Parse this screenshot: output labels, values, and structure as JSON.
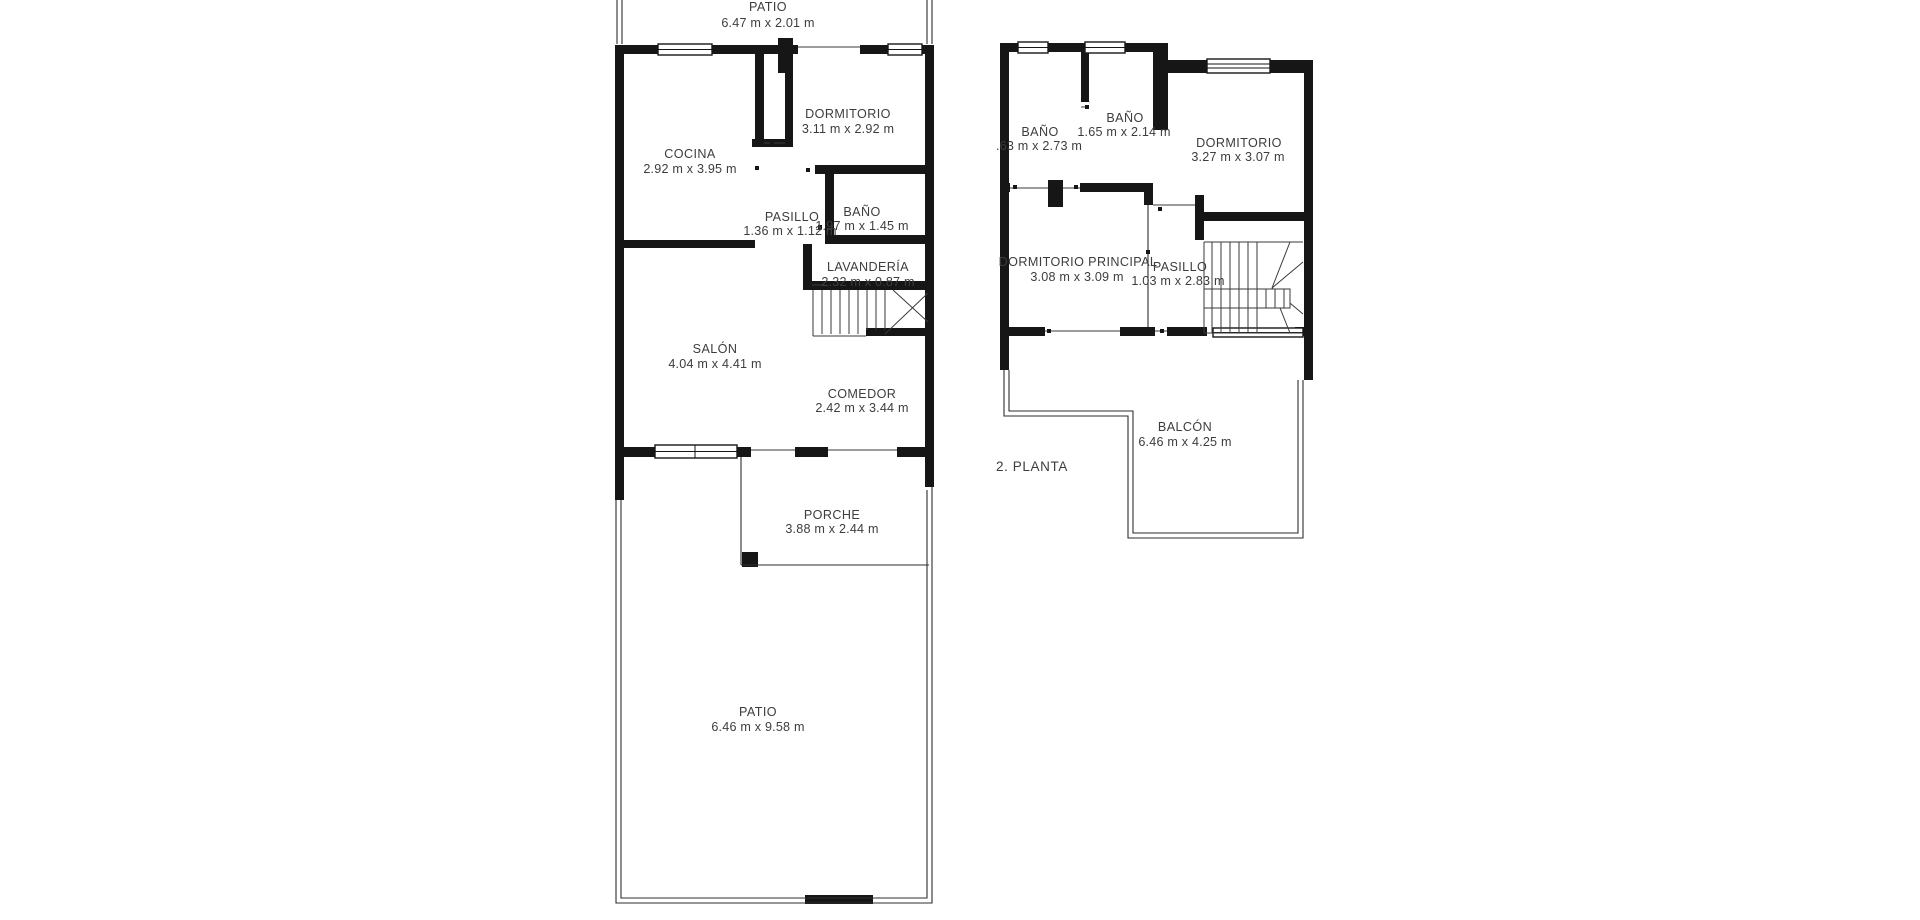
{
  "meta": {
    "background_color": "#ffffff",
    "wall_color": "#161616",
    "text_color": "#3d3d3d"
  },
  "floor1": {
    "rooms": [
      {
        "name": "PATIO",
        "dims": "6.47 m x 2.01 m"
      },
      {
        "name": "DORMITORIO",
        "dims": "3.11 m x 2.92 m"
      },
      {
        "name": "COCINA",
        "dims": "2.92 m x 3.95 m"
      },
      {
        "name": "PASILLO",
        "dims": "1.36 m x 1.12 m"
      },
      {
        "name": "BAÑO",
        "dims": "1.97 m x 1.45 m"
      },
      {
        "name": "LAVANDERÍA",
        "dims": "2.32 m x 0.87 m"
      },
      {
        "name": "SALÓN",
        "dims": "4.04 m x 4.41 m"
      },
      {
        "name": "COMEDOR",
        "dims": "2.42 m x 3.44 m"
      },
      {
        "name": "PORCHE",
        "dims": "3.88 m x 2.44 m"
      },
      {
        "name": "PATIO",
        "dims": "6.46 m x 9.58 m"
      }
    ]
  },
  "floor2": {
    "label": "2. PLANTA",
    "rooms": [
      {
        "name": "BAÑO",
        "dims": ".63 m x 2.73 m"
      },
      {
        "name": "BAÑO",
        "dims": "1.65 m x 2.14 m"
      },
      {
        "name": "DORMITORIO",
        "dims": "3.27 m x 3.07 m"
      },
      {
        "name": "DORMITORIO PRINCIPAL",
        "dims": "3.08 m x 3.09 m"
      },
      {
        "name": "PASILLO",
        "dims": "1.03 m x 2.83 m"
      },
      {
        "name": "BALCÓN",
        "dims": "6.46 m x 4.25 m"
      }
    ]
  }
}
